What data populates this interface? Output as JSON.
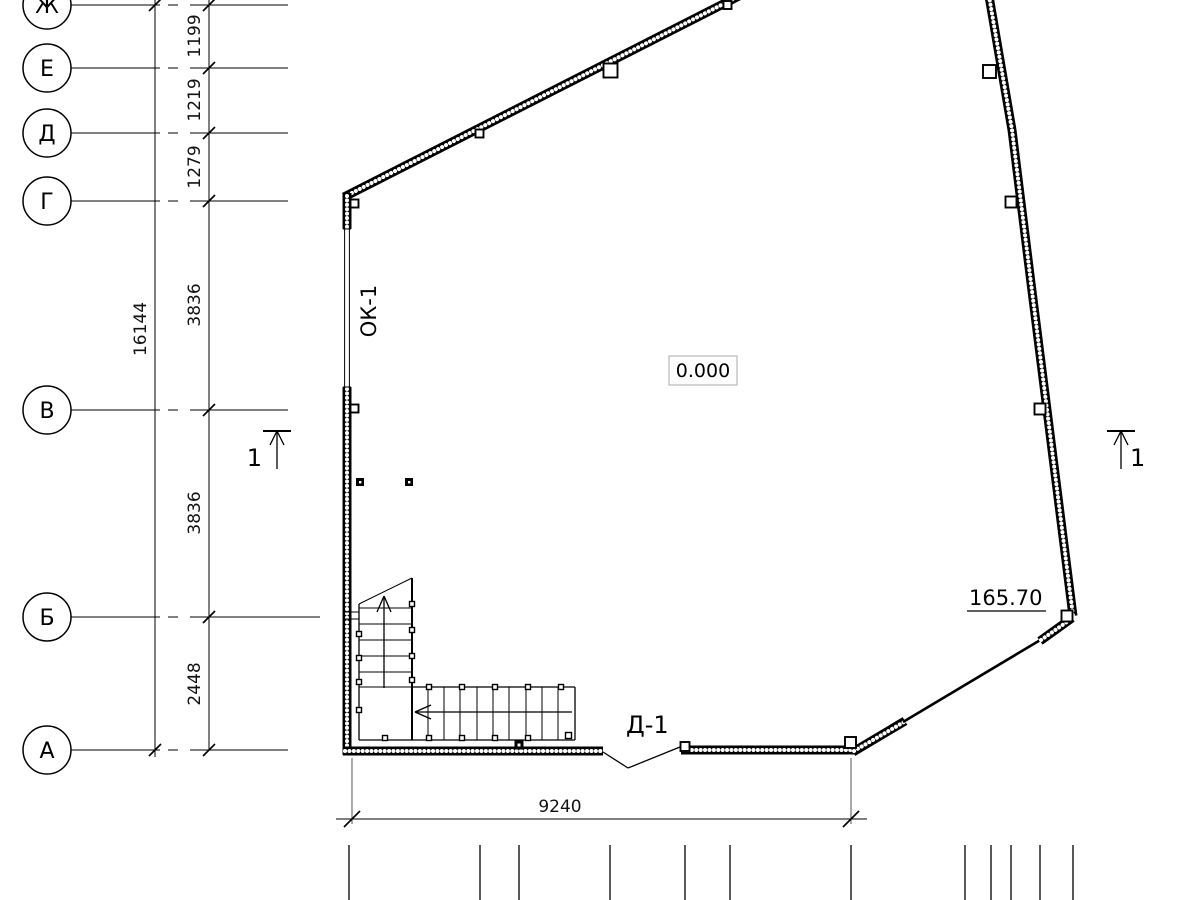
{
  "sheet": {
    "type_note": "architectural floor plan fragment",
    "background": "#ffffff",
    "line_color": "#000000"
  },
  "grid": {
    "axes": [
      {
        "label": "Ж"
      },
      {
        "label": "Е"
      },
      {
        "label": "Д"
      },
      {
        "label": "Г"
      },
      {
        "label": "В"
      },
      {
        "label": "Б"
      },
      {
        "label": "А"
      }
    ],
    "segment_dims": [
      "1199",
      "1219",
      "1279",
      "3836",
      "3836",
      "2448"
    ],
    "overall_dim": "16144"
  },
  "plan": {
    "window_tag": "ОК-1",
    "door_tag": "Д-1",
    "level_mark": "0.000",
    "elevation_mark": "165.70",
    "width_dim": "9240",
    "section_number": "1"
  }
}
